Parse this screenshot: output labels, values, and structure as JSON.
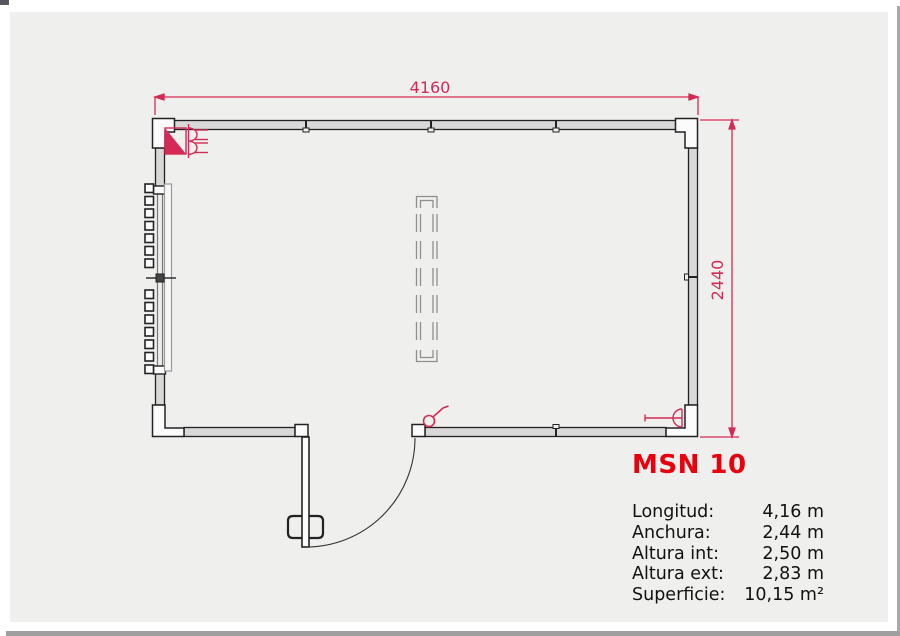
{
  "page": {
    "background": "#efefee",
    "frame_color": "#a9a9a9"
  },
  "plan": {
    "dim_width_label": "4160",
    "dim_height_label": "2440",
    "colors": {
      "dimension_red": "#d42a55",
      "symbol_red": "#d42a55",
      "wall_stroke": "#222222",
      "wall_fill": "#d8d8d8",
      "beam_gray": "#8f8f8f"
    },
    "symbols": [
      "electrical-panel-symbol",
      "window-with-shutter-slats",
      "window-handle",
      "roof-beam-dashed",
      "door-leaf-with-swing-arc",
      "door-key-symbol",
      "power-socket-symbol"
    ]
  },
  "specs": {
    "title": "MSN 10",
    "title_color": "#e8000d",
    "rows": [
      {
        "label": "Longitud:",
        "value": "4,16 m"
      },
      {
        "label": "Anchura:",
        "value": "2,44 m"
      },
      {
        "label": "Altura int:",
        "value": "2,50 m"
      },
      {
        "label": "Altura ext:",
        "value": "2,83 m"
      },
      {
        "label": "Superficie:",
        "value": "10,15 m²"
      }
    ]
  }
}
